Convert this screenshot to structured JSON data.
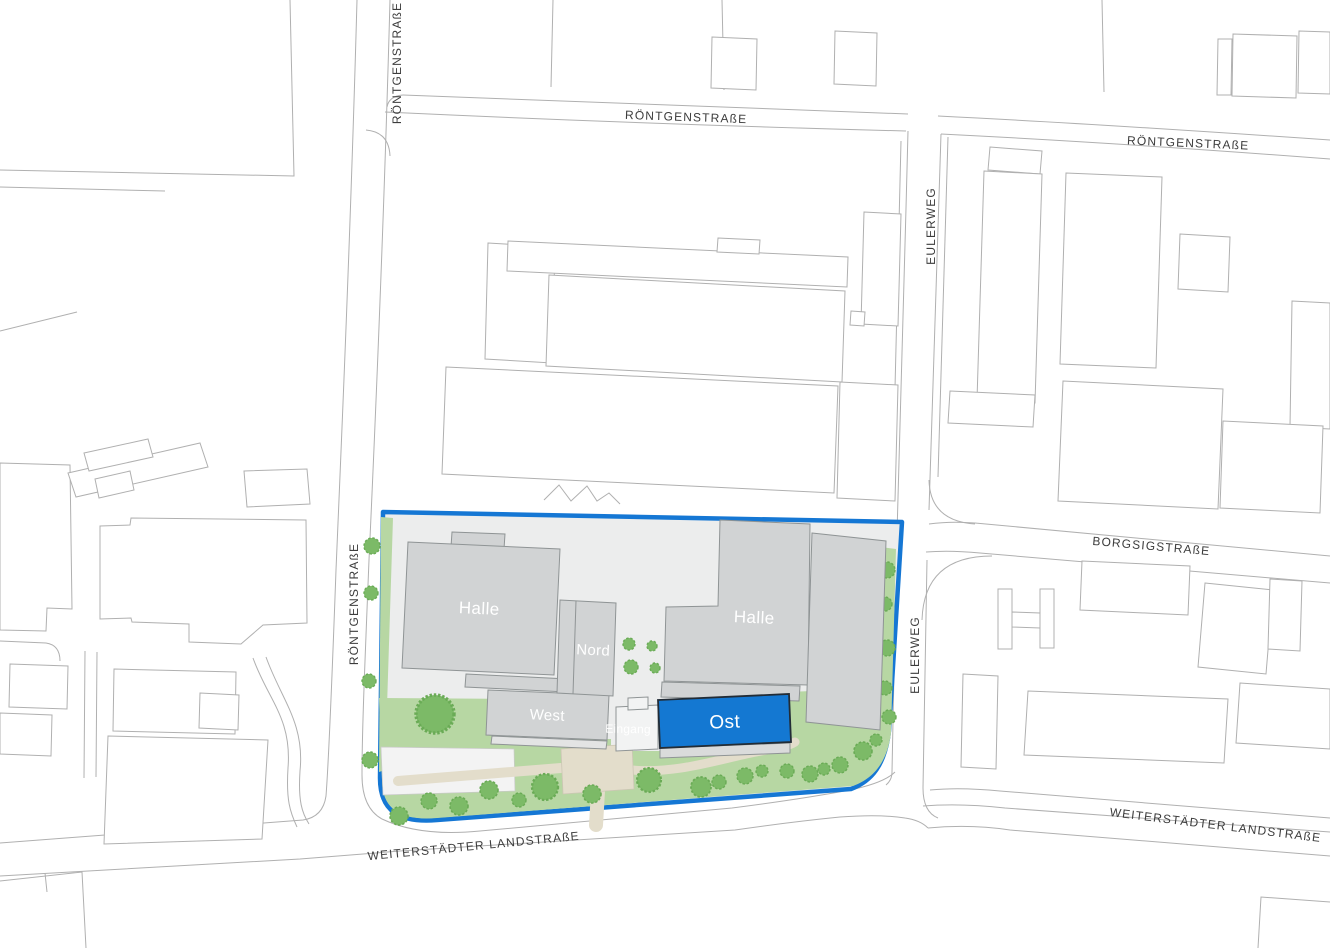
{
  "map_title": "Site plan",
  "streets": {
    "rontgen_v_top": "RÖNTGENSTRAßE",
    "rontgen_h_top": "RÖNTGENSTRAßE",
    "rontgen_h_topright": "RÖNTGENSTRAßE",
    "rontgen_v_mid": "RÖNTGENSTRAßE",
    "eulerweg_top": "EULERWEG",
    "eulerweg_mid": "EULERWEG",
    "borgsig": "BORGSIGSTRAßE",
    "weiterstadt_left": "WEITERSTÄDTER LANDSTRAßE",
    "weiterstadt_right": "WEITERSTÄDTER LANDSTRAßE"
  },
  "site_buildings": {
    "halle_west": "Halle",
    "halle_east": "Halle",
    "nord": "Nord",
    "west": "West",
    "ost": "Ost",
    "eingang": "Eingang"
  },
  "colors": {
    "outline": "#b0b0b0",
    "street_label": "#3c3c3c",
    "site_boundary": "#1577D4",
    "site_ground": "#ECEDED",
    "green": "#B7D7A3",
    "tree": "#7CBA67",
    "tree_edge": "#6AAB56",
    "path_fill": "#E3DDCB",
    "path_edge": "#CCC6B4",
    "building": "#D1D3D4",
    "building_edge": "#8F9495",
    "building_label": "#FFFFFF",
    "highlight": "#1478D2",
    "highlight_edge": "#222C36",
    "entrance_fill": "#F2F3F3",
    "paved_fill": "#F3F3F3"
  }
}
